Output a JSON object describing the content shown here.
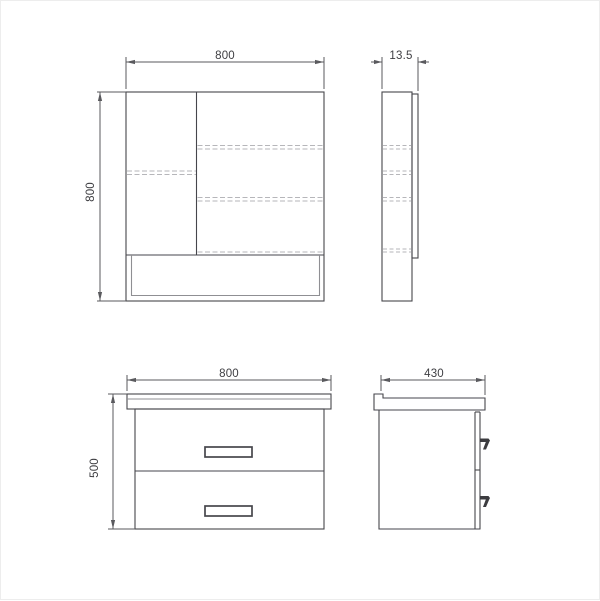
{
  "drawing": {
    "colors": {
      "line": "#46464c",
      "secondary_line": "#8f8f93",
      "dashed_line": "#b6b6ba",
      "dimension_line": "#5a5a5e",
      "text": "#3e3e42",
      "background": "#ffffff"
    },
    "views": {
      "mirror_front": {
        "width_dim": "800",
        "height_dim": "800"
      },
      "mirror_side": {
        "depth_dim": "13.5"
      },
      "vanity_front": {
        "width_dim": "800",
        "height_dim": "500"
      },
      "vanity_side": {
        "depth_dim": "430"
      }
    }
  }
}
